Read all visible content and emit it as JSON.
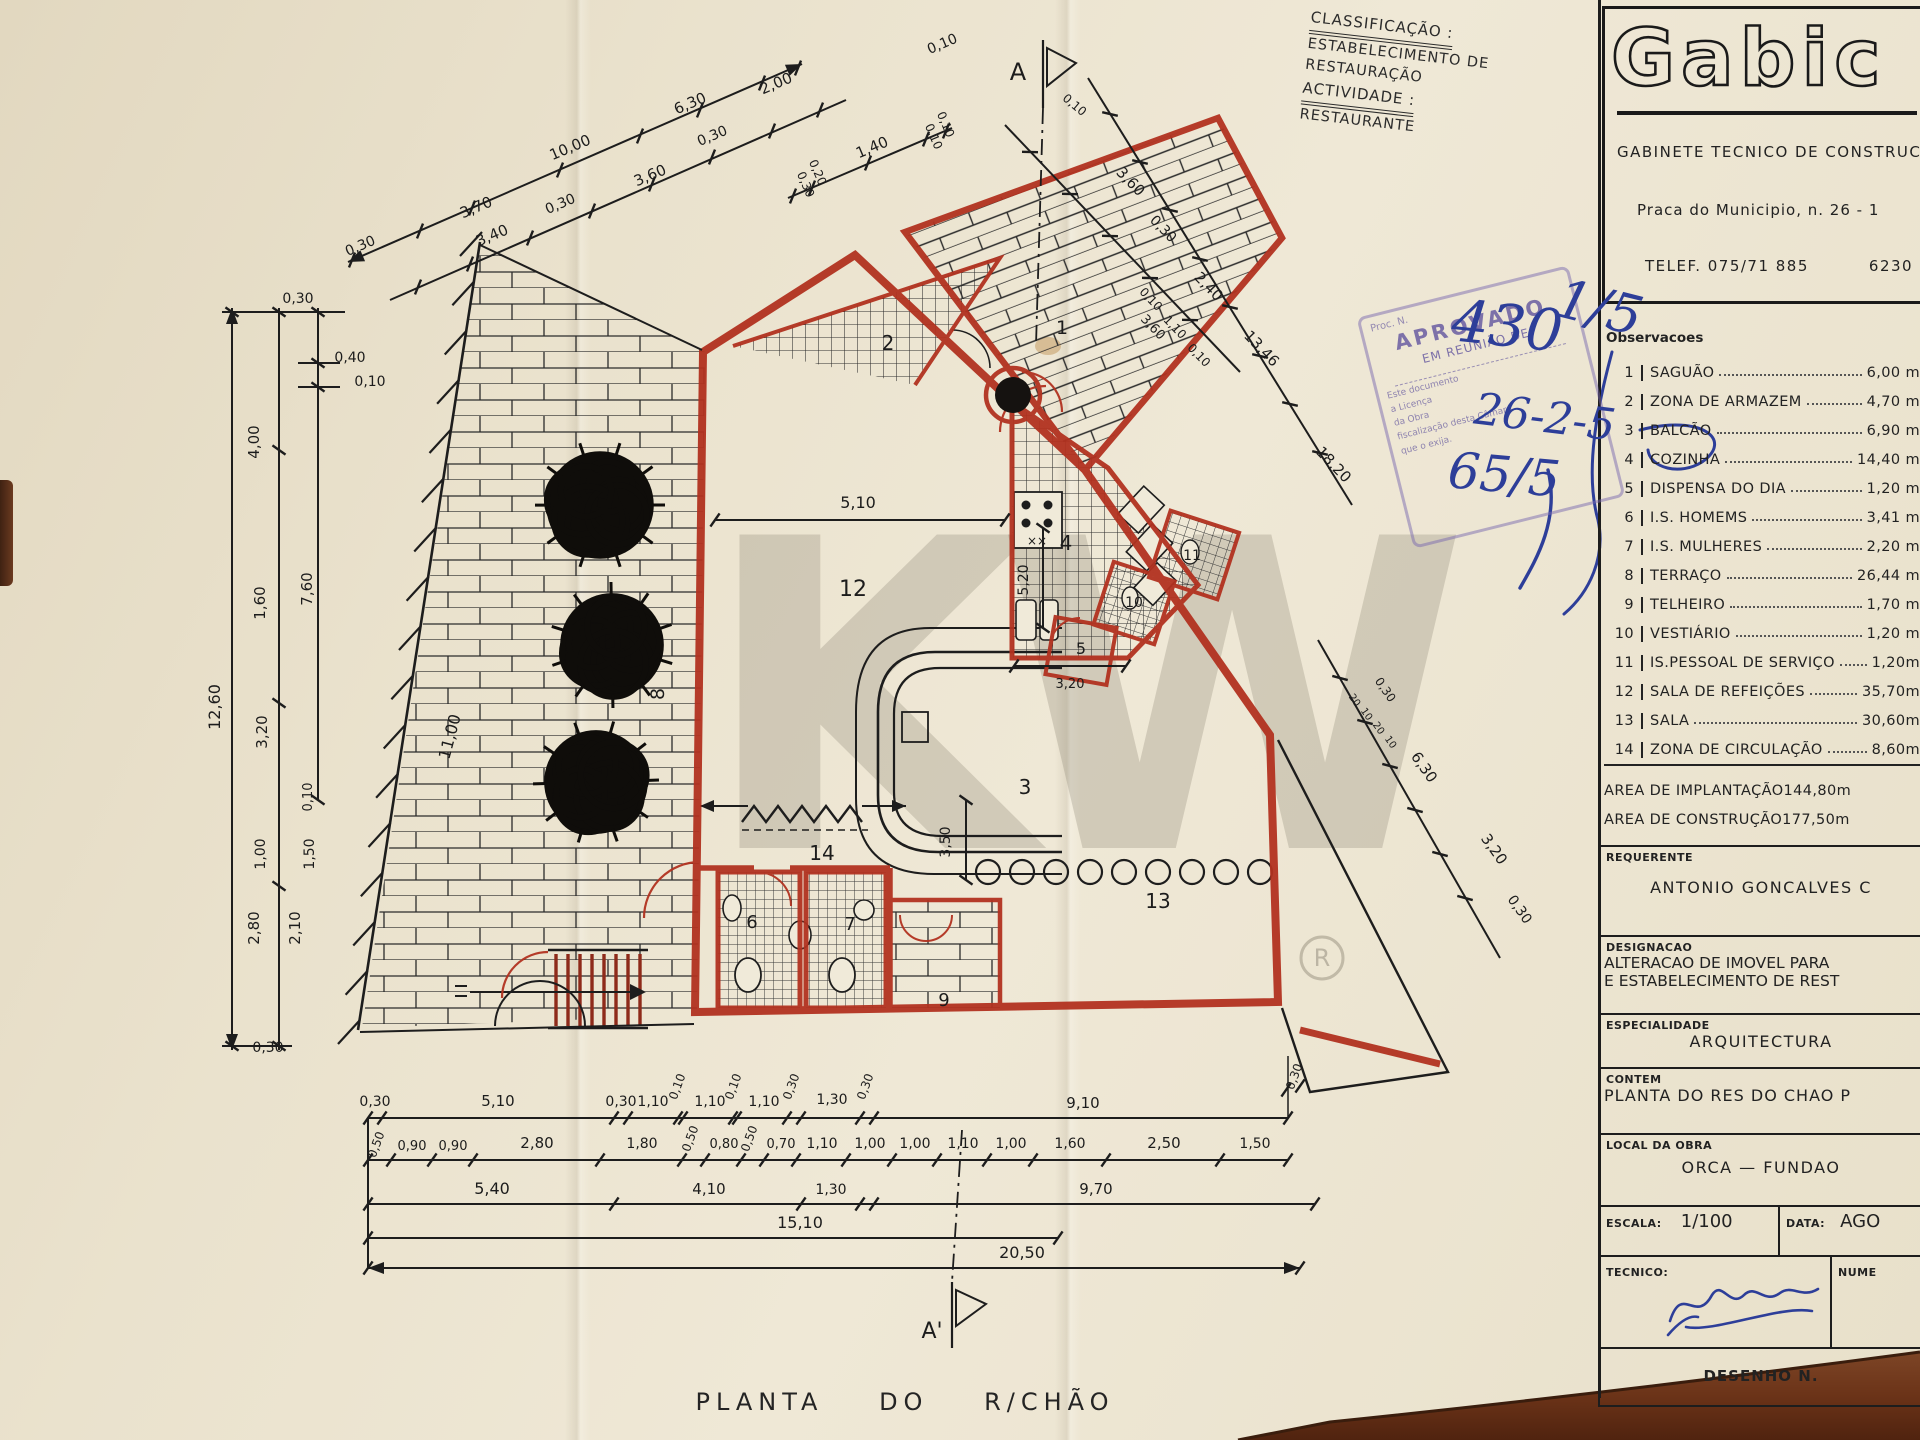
{
  "classification": {
    "label": "CLASSIFICAÇÃO :",
    "value": "ESTABELECIMENTO DE RESTAURAÇÃO",
    "activity_label": "ACTIVIDADE :",
    "activity_value": "RESTAURANTE"
  },
  "firm": {
    "logo": "Gabic",
    "name": "GABINETE TECNICO DE CONSTRUCAO",
    "address": "Praca do Municipio, n. 26 - 1",
    "phone": "TELEF. 075/71 885",
    "code": "6230"
  },
  "observacoes": {
    "title": "Observacoes",
    "rooms": [
      {
        "num": "1",
        "name": "SAGUÃO",
        "area": "6,00 m"
      },
      {
        "num": "2",
        "name": "ZONA DE ARMAZEM",
        "area": "4,70 m"
      },
      {
        "num": "3",
        "name": "BALCÃO",
        "area": "6,90 m"
      },
      {
        "num": "4",
        "name": "COZINHA",
        "area": "14,40 m"
      },
      {
        "num": "5",
        "name": "DISPENSA DO DIA",
        "area": "1,20 m"
      },
      {
        "num": "6",
        "name": "I.S. HOMEMS",
        "area": "3,41 m"
      },
      {
        "num": "7",
        "name": "I.S. MULHERES",
        "area": "2,20 m"
      },
      {
        "num": "8",
        "name": "TERRAÇO",
        "area": "26,44 m"
      },
      {
        "num": "9",
        "name": "TELHEIRO",
        "area": "1,70 m"
      },
      {
        "num": "10",
        "name": "VESTIÁRIO",
        "area": "1,20 m"
      },
      {
        "num": "11",
        "name": "IS.PESSOAL DE SERVIÇO",
        "area": "1,20m"
      },
      {
        "num": "12",
        "name": "SALA DE REFEIÇÕES",
        "area": "35,70m"
      },
      {
        "num": "13",
        "name": "SALA",
        "area": "30,60m"
      },
      {
        "num": "14",
        "name": "ZONA DE CIRCULAÇÃO",
        "area": "8,60m"
      }
    ],
    "areas": [
      {
        "label": "AREA DE IMPLANTAÇÃO",
        "value": "144,80m"
      },
      {
        "label": "AREA DE CONSTRUÇÃO",
        "value": "177,50m"
      }
    ]
  },
  "titleblock": {
    "requerente_label": "REQUERENTE",
    "requerente": "ANTONIO GONCALVES C",
    "designacao_label": "DESIGNACAO",
    "designacao_line1": "ALTERACAO DE IMOVEL PARA",
    "designacao_line2": "E ESTABELECIMENTO DE REST",
    "especialidade_label": "ESPECIALIDADE",
    "especialidade": "ARQUITECTURA",
    "contem_label": "CONTEM",
    "contem": "PLANTA DO RES DO CHAO P",
    "local_label": "LOCAL DA OBRA",
    "local": "ORCA — FUNDAO",
    "escala_label": "ESCALA:",
    "escala": "1/100",
    "data_label": "DATA:",
    "data": "AGO",
    "tecnico_label": "TECNICO:",
    "numero_label": "NUME",
    "desenho_label": "DESENHO N."
  },
  "stamp": {
    "l1": "Proc. N.",
    "l2": "APROVADO",
    "l3": "EM REUNIÃO DE",
    "l4": "Este documento",
    "l5": "a Licença",
    "l6": "da Obra",
    "l7": "fiscalização desta Câmara",
    "l8": "que o exija."
  },
  "handwriting": {
    "h1": "430",
    "h2": "1/5",
    "h3": "26-2-5",
    "h4": "65/5"
  },
  "plan": {
    "title": "PLANTA DO R/CHÃO",
    "section_top": "A",
    "section_bottom": "A'",
    "watermark": "KW",
    "registered": "R",
    "rooms": [
      "1",
      "2",
      "3",
      "4",
      "5",
      "6",
      "7",
      "8",
      "9",
      "10",
      "11",
      "12",
      "13",
      "14"
    ]
  },
  "dims": {
    "top": [
      "0,30",
      "3,70",
      "3,40",
      "10,00",
      "0,30",
      "3,60",
      "6,30",
      "0,30",
      "2,00",
      "1,40",
      "0,10"
    ],
    "topsm": [
      "0,30",
      "0,20",
      "0,10",
      "0,10",
      "0,10"
    ],
    "left": [
      "0,30",
      "0,40",
      "0,10",
      "4,00",
      "7,60",
      "1,60",
      "12,60",
      "3,20",
      "0,10",
      "1,00",
      "1,50",
      "2,80",
      "2,10",
      "0,30",
      "11,00"
    ],
    "right": [
      "3,60",
      "0,30",
      "2,40",
      "13,46",
      "18,20",
      "0,10",
      "1,10",
      "0,10"
    ],
    "lower": [
      "6,30",
      "3,20",
      "0,30",
      "0,30"
    ],
    "micro": [
      "20",
      "10",
      "20",
      "10"
    ],
    "b1": [
      "0,30",
      "5,10",
      "0,30",
      "1,10",
      "0,10",
      "1,10",
      "0,10",
      "1,10",
      "0,30",
      "1,30",
      "0,30",
      "9,10",
      "0,30"
    ],
    "b2": [
      "0,50",
      "0,90",
      "0,90",
      "2,80",
      "1,80",
      "0,50",
      "0,80",
      "0,50",
      "0,70",
      "1,10",
      "1,00",
      "1,00",
      "1,10",
      "1,00",
      "1,60",
      "2,50",
      "1,50"
    ],
    "b3": [
      "5,40",
      "4,10",
      "1,30",
      "9,70"
    ],
    "b4": [
      "15,10"
    ],
    "b5": [
      "20,50"
    ],
    "inner": [
      "5,10",
      "5,20",
      "3,20",
      "3,50",
      "3,60"
    ]
  }
}
